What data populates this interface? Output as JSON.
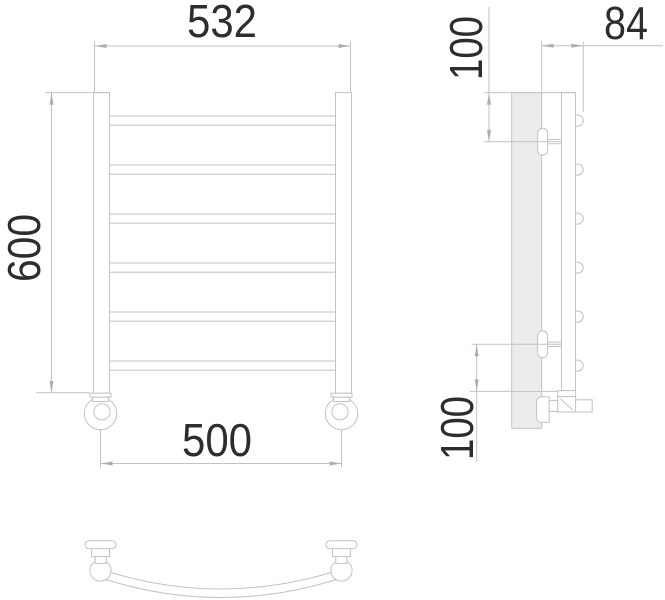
{
  "dims": {
    "front_width": "532",
    "front_height": "600",
    "mount_spacing": "500",
    "side_depth": "84",
    "side_top_offset": "100",
    "side_bottom_offset": "100"
  },
  "colors": {
    "line-color": "#c2c2c2",
    "text-color": "#2d2d2d",
    "wall-fill": "#ececec",
    "arrow-color": "#aeaeae"
  }
}
